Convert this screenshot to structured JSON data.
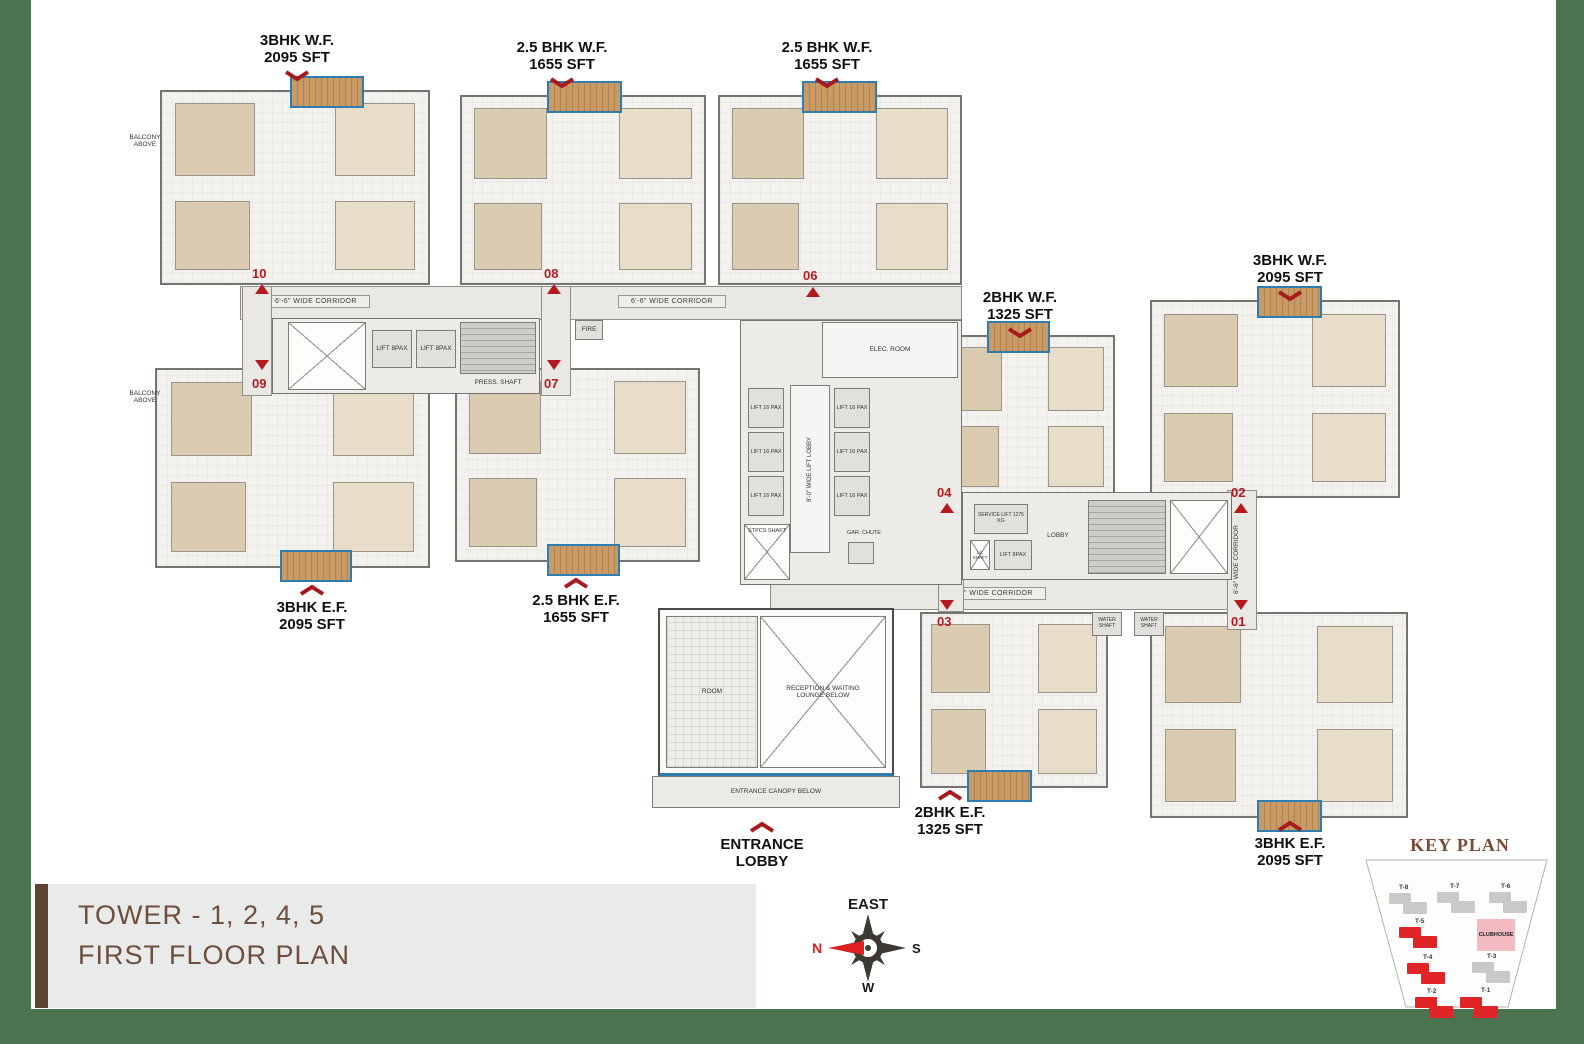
{
  "colors": {
    "frame_green": "#4a7350",
    "title_bar_brown": "#5e4334",
    "title_text_brown": "#6f4e3c",
    "marker_red": "#b5191e",
    "chevron_red": "#a6191c",
    "keyplan_highlight_red": "#e02427",
    "balcony_wood": "#c79a66",
    "balcony_edge_blue": "#2f7cb0"
  },
  "title_block": {
    "line1": "TOWER - 1, 2, 4, 5",
    "line2": "FIRST FLOOR PLAN"
  },
  "compass": {
    "top": "EAST",
    "left": "N",
    "right": "S",
    "bottom": "W"
  },
  "key_plan": {
    "title": "KEY PLAN",
    "clubhouse_label": "CLUBHOUSE",
    "towers": [
      {
        "label": "T-8",
        "highlighted": false
      },
      {
        "label": "T-7",
        "highlighted": false
      },
      {
        "label": "T-6",
        "highlighted": false
      },
      {
        "label": "T-5",
        "highlighted": true
      },
      {
        "label": "T-4",
        "highlighted": true
      },
      {
        "label": "T-3",
        "highlighted": false
      },
      {
        "label": "T-2",
        "highlighted": true
      },
      {
        "label": "T-1",
        "highlighted": true
      }
    ]
  },
  "callouts": [
    {
      "line1": "3BHK W.F.",
      "line2": "2095 SFT",
      "direction": "down"
    },
    {
      "line1": "2.5 BHK W.F.",
      "line2": "1655 SFT",
      "direction": "down"
    },
    {
      "line1": "2.5 BHK W.F.",
      "line2": "1655 SFT",
      "direction": "down"
    },
    {
      "line1": "2BHK W.F.",
      "line2": "1325 SFT",
      "direction": "down"
    },
    {
      "line1": "3BHK W.F.",
      "line2": "2095 SFT",
      "direction": "down"
    },
    {
      "line1": "3BHK E.F.",
      "line2": "2095 SFT",
      "direction": "up"
    },
    {
      "line1": "2.5 BHK E.F.",
      "line2": "1655 SFT",
      "direction": "up"
    },
    {
      "line1": "2BHK E.F.",
      "line2": "1325 SFT",
      "direction": "up"
    },
    {
      "line1": "3BHK E.F.",
      "line2": "2095 SFT",
      "direction": "up"
    },
    {
      "line1": "ENTRANCE",
      "line2": "LOBBY",
      "direction": "up"
    }
  ],
  "unit_markers": [
    "10",
    "09",
    "08",
    "07",
    "06",
    "04",
    "03",
    "02",
    "01"
  ],
  "plan_labels": {
    "corridor": "6'-6\" WIDE CORRIDOR",
    "lift_lobby": "8'-0\" WIDE LIFT LOBBY",
    "lift_8pax": "LIFT 8PAX",
    "lift_16pax": "LIFT 16 PAX",
    "elec_room": "ELEC. ROOM",
    "service_lift": "SERVICE LIFT 1275 KG",
    "lobby": "LOBBY",
    "press_shaft": "PRESS. SHAFT",
    "fire": "FIRE",
    "stpcs_shaft": "STPCS SHAFT",
    "gar_chute": "GAR. CHUTE",
    "water_shaft": "WATER SHAFT",
    "lc_shaft": "LC SHAFT",
    "room": "ROOM",
    "reception": "RECEPTION & WAITING LOUNGE BELOW",
    "canopy": "ENTRANCE CANOPY BELOW",
    "balcony_above": "BALCONY ABOVE"
  }
}
